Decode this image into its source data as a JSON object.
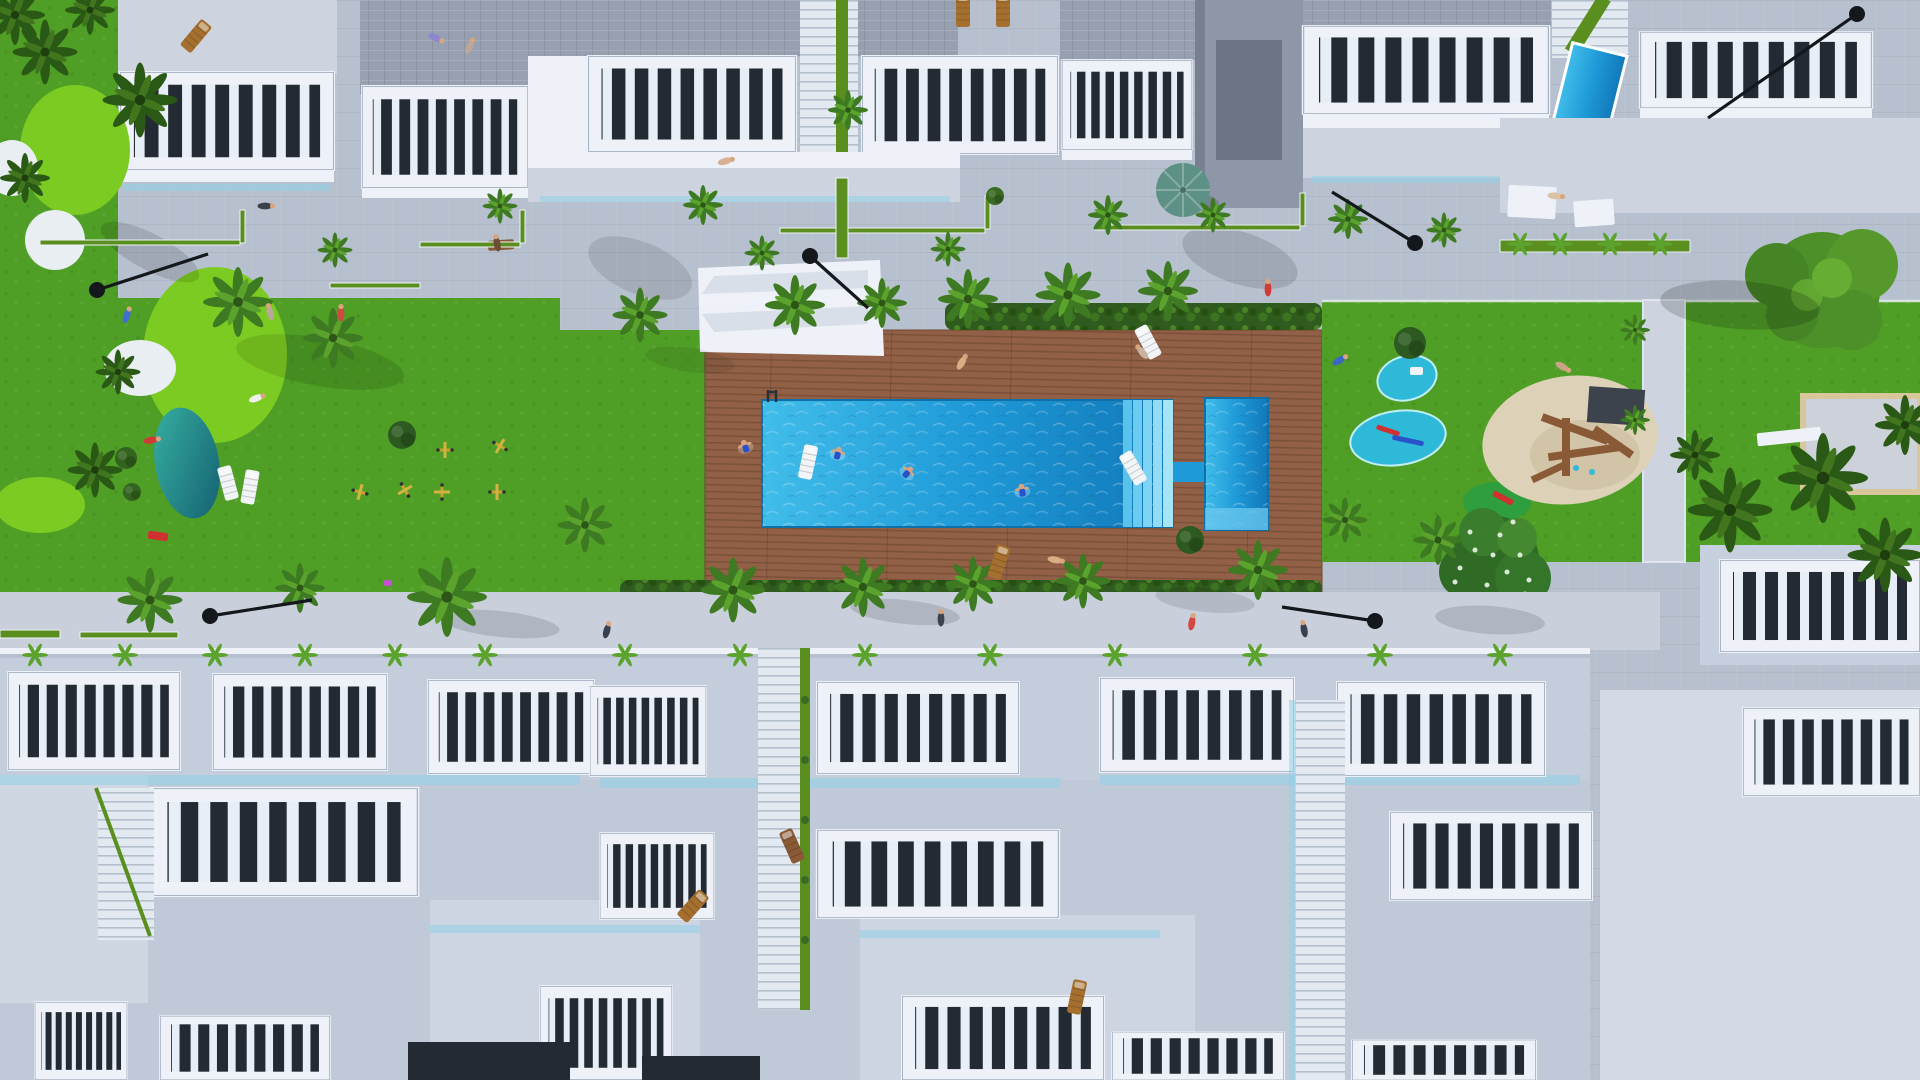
{
  "title": "aerial-render-residential-complex-with-pool",
  "colors": {
    "pavement": "#b7c0ce",
    "pavement_light": "#cdd4e0",
    "building_white": "#eef2f8",
    "building_shadow": "#c6d0de",
    "roof_gray": "#96a0b0",
    "facade_dark": "#8d97a8",
    "window_dark": "#232a33",
    "lawn": "#4f9e25",
    "lawn_light": "#63b52e",
    "golf_green": "#7ccb22",
    "bunker_white": "#e9eef2",
    "hedge": "#2f5c1e",
    "palm": "#3d7a22",
    "palm_light": "#5ca32e",
    "trunk": "#9b7d52",
    "deck": "#916046",
    "deck_stripe": "#7a5037",
    "pool_light": "#7fd4f2",
    "pool_mid": "#1f9ad8",
    "pool_deep": "#1480bf",
    "splash": "#2fb9d8",
    "sand": "#ddd2b8",
    "wood": "#8a5a36",
    "umbrella": "#5e9186",
    "mound_teal": "#1f8a8c",
    "lamp_black": "#14181d",
    "gym_yellow": "#c8a22c",
    "stair_green": "#5a8f1f",
    "court_gray": "#cdd2da",
    "court_border": "#d9c79c",
    "glass_blue": "#8fd2e8"
  },
  "scene": {
    "palms": [
      {
        "x": 45,
        "y": 52,
        "s": 1.3,
        "d": 1
      },
      {
        "x": 140,
        "y": 100,
        "s": 1.5,
        "d": 1
      },
      {
        "x": 25,
        "y": 178,
        "s": 1.0,
        "d": 1
      },
      {
        "x": 15,
        "y": 15,
        "s": 1.2,
        "d": 1
      },
      {
        "x": 90,
        "y": 10,
        "s": 1.0,
        "d": 1
      },
      {
        "x": 238,
        "y": 302,
        "s": 1.4
      },
      {
        "x": 333,
        "y": 338,
        "s": 1.2
      },
      {
        "x": 118,
        "y": 372,
        "s": 0.9,
        "d": 1
      },
      {
        "x": 95,
        "y": 470,
        "s": 1.1,
        "d": 1
      },
      {
        "x": 640,
        "y": 315,
        "s": 1.1
      },
      {
        "x": 795,
        "y": 305,
        "s": 1.2
      },
      {
        "x": 882,
        "y": 303,
        "s": 1.0
      },
      {
        "x": 968,
        "y": 299,
        "s": 1.2
      },
      {
        "x": 1068,
        "y": 295,
        "s": 1.3
      },
      {
        "x": 1168,
        "y": 291,
        "s": 1.2
      },
      {
        "x": 848,
        "y": 110,
        "s": 0.8
      },
      {
        "x": 335,
        "y": 250,
        "s": 0.7
      },
      {
        "x": 500,
        "y": 206,
        "s": 0.7
      },
      {
        "x": 703,
        "y": 205,
        "s": 0.8
      },
      {
        "x": 762,
        "y": 253,
        "s": 0.7
      },
      {
        "x": 948,
        "y": 249,
        "s": 0.7
      },
      {
        "x": 1108,
        "y": 215,
        "s": 0.8
      },
      {
        "x": 1213,
        "y": 215,
        "s": 0.7
      },
      {
        "x": 1348,
        "y": 219,
        "s": 0.8
      },
      {
        "x": 1444,
        "y": 230,
        "s": 0.7
      },
      {
        "x": 150,
        "y": 600,
        "s": 1.3
      },
      {
        "x": 300,
        "y": 588,
        "s": 1.0
      },
      {
        "x": 447,
        "y": 597,
        "s": 1.6
      },
      {
        "x": 585,
        "y": 525,
        "s": 1.1
      },
      {
        "x": 733,
        "y": 590,
        "s": 1.3
      },
      {
        "x": 863,
        "y": 587,
        "s": 1.2
      },
      {
        "x": 973,
        "y": 584,
        "s": 1.1
      },
      {
        "x": 1083,
        "y": 581,
        "s": 1.1
      },
      {
        "x": 1258,
        "y": 570,
        "s": 1.2
      },
      {
        "x": 1345,
        "y": 520,
        "s": 0.9
      },
      {
        "x": 1438,
        "y": 540,
        "s": 1.0
      },
      {
        "x": 1730,
        "y": 510,
        "s": 1.7,
        "d": 1
      },
      {
        "x": 1823,
        "y": 478,
        "s": 1.8,
        "d": 1
      },
      {
        "x": 1885,
        "y": 555,
        "s": 1.5,
        "d": 1
      },
      {
        "x": 1905,
        "y": 425,
        "s": 1.2,
        "d": 1
      },
      {
        "x": 1695,
        "y": 455,
        "s": 1.0,
        "d": 1
      },
      {
        "x": 1635,
        "y": 330,
        "s": 0.6
      },
      {
        "x": 1635,
        "y": 420,
        "s": 0.6
      }
    ],
    "agaves": [
      {
        "x": 35,
        "y": 655
      },
      {
        "x": 125,
        "y": 655
      },
      {
        "x": 215,
        "y": 655
      },
      {
        "x": 305,
        "y": 655
      },
      {
        "x": 395,
        "y": 655
      },
      {
        "x": 485,
        "y": 655
      },
      {
        "x": 625,
        "y": 655
      },
      {
        "x": 740,
        "y": 655
      },
      {
        "x": 865,
        "y": 655
      },
      {
        "x": 990,
        "y": 655
      },
      {
        "x": 1115,
        "y": 655
      },
      {
        "x": 1255,
        "y": 655
      },
      {
        "x": 1380,
        "y": 655
      },
      {
        "x": 1500,
        "y": 655
      },
      {
        "x": 1520,
        "y": 244
      },
      {
        "x": 1560,
        "y": 244
      },
      {
        "x": 1610,
        "y": 244
      },
      {
        "x": 1660,
        "y": 244
      }
    ],
    "lamps": [
      {
        "hx": 97,
        "hy": 290,
        "tx": 208,
        "ty": 254
      },
      {
        "hx": 810,
        "hy": 256,
        "tx": 868,
        "ty": 308
      },
      {
        "hx": 210,
        "hy": 616,
        "tx": 312,
        "ty": 600
      },
      {
        "hx": 1375,
        "hy": 621,
        "tx": 1282,
        "ty": 607
      },
      {
        "hx": 1415,
        "hy": 243,
        "tx": 1332,
        "ty": 192
      },
      {
        "hx": 1857,
        "hy": 14,
        "tx": 1708,
        "ty": 118
      }
    ],
    "people": [
      {
        "x": 127,
        "y": 315,
        "c": "#3f6fd0",
        "r": 20
      },
      {
        "x": 152,
        "y": 440,
        "c": "#d03b35",
        "r": 80
      },
      {
        "x": 270,
        "y": 312,
        "c": "#b9a79a",
        "r": -15
      },
      {
        "x": 341,
        "y": 313,
        "c": "#d24840",
        "r": 0
      },
      {
        "x": 266,
        "y": 206,
        "c": "#3a4048",
        "r": 90
      },
      {
        "x": 436,
        "y": 38,
        "c": "#8f86cf",
        "r": 115
      },
      {
        "x": 497,
        "y": 243,
        "c": "#6a4e35",
        "r": -10
      },
      {
        "x": 726,
        "y": 161,
        "c": "#d8b096",
        "r": 75
      },
      {
        "x": 962,
        "y": 362,
        "c": "#d9ad85",
        "r": 30
      },
      {
        "x": 1142,
        "y": 352,
        "c": "#c7b39f",
        "r": -40
      },
      {
        "x": 1056,
        "y": 560,
        "c": "#d9ad85",
        "r": 100
      },
      {
        "x": 941,
        "y": 618,
        "c": "#3c4452",
        "r": 0
      },
      {
        "x": 1192,
        "y": 622,
        "c": "#d24840",
        "r": 10
      },
      {
        "x": 1304,
        "y": 629,
        "c": "#39414e",
        "r": -10
      },
      {
        "x": 1268,
        "y": 288,
        "c": "#d03b35",
        "r": 0
      },
      {
        "x": 1556,
        "y": 196,
        "c": "#d9c3a4",
        "r": 95
      },
      {
        "x": 1340,
        "y": 360,
        "c": "#3e67c5",
        "r": 60
      },
      {
        "x": 1563,
        "y": 367,
        "c": "#caa285",
        "r": 120
      },
      {
        "x": 470,
        "y": 46,
        "c": "#b9a79a",
        "r": 25
      },
      {
        "x": 607,
        "y": 630,
        "c": "#39414e",
        "r": 15
      },
      {
        "x": 257,
        "y": 398,
        "c": "#eeeeee",
        "r": 70
      }
    ],
    "swimmers": [
      {
        "x": 745,
        "y": 446,
        "r": -20
      },
      {
        "x": 838,
        "y": 453,
        "r": 15
      },
      {
        "x": 908,
        "y": 472,
        "r": 40
      },
      {
        "x": 1022,
        "y": 490,
        "r": -10
      }
    ],
    "loungers": [
      {
        "x": 196,
        "y": 36,
        "r": 40,
        "c": "#a5702f"
      },
      {
        "x": 963,
        "y": 10,
        "r": 0,
        "c": "#a5702f"
      },
      {
        "x": 1003,
        "y": 10,
        "r": 0,
        "c": "#a5702f"
      },
      {
        "x": 1148,
        "y": 342,
        "r": -28,
        "c": "#f2f5f8"
      },
      {
        "x": 999,
        "y": 562,
        "r": 18,
        "c": "#a5702f"
      },
      {
        "x": 808,
        "y": 462,
        "r": 12,
        "c": "#f2f5f8"
      },
      {
        "x": 693,
        "y": 906,
        "r": 42,
        "c": "#a5702f"
      },
      {
        "x": 792,
        "y": 846,
        "r": -24,
        "c": "#8a5a36"
      },
      {
        "x": 1077,
        "y": 997,
        "r": 12,
        "c": "#a5702f"
      },
      {
        "x": 228,
        "y": 483,
        "r": -15,
        "c": "#f2f5f8"
      },
      {
        "x": 250,
        "y": 487,
        "r": 10,
        "c": "#f2f5f8"
      },
      {
        "x": 1133,
        "y": 468,
        "r": -30,
        "c": "#f2f5f8"
      }
    ],
    "gym": [
      {
        "x": 445,
        "y": 450
      },
      {
        "x": 500,
        "y": 446,
        "r": 30
      },
      {
        "x": 442,
        "y": 492,
        "r": 90
      },
      {
        "x": 497,
        "y": 492
      },
      {
        "x": 360,
        "y": 492,
        "r": 15
      },
      {
        "x": 405,
        "y": 490,
        "r": 60
      }
    ],
    "green_strips": [
      {
        "x": 40,
        "y": 240,
        "w": 200,
        "h": 5
      },
      {
        "x": 420,
        "y": 242,
        "w": 100,
        "h": 5
      },
      {
        "x": 780,
        "y": 228,
        "w": 205,
        "h": 5
      },
      {
        "x": 1095,
        "y": 225,
        "w": 205,
        "h": 5
      },
      {
        "x": 330,
        "y": 283,
        "w": 90,
        "h": 5
      },
      {
        "x": 240,
        "y": 210,
        "w": 5,
        "h": 33
      },
      {
        "x": 520,
        "y": 210,
        "w": 5,
        "h": 33
      },
      {
        "x": 985,
        "y": 196,
        "w": 5,
        "h": 33
      },
      {
        "x": 1300,
        "y": 193,
        "w": 5,
        "h": 33
      },
      {
        "x": 836,
        "y": 178,
        "w": 12,
        "h": 80
      },
      {
        "x": 0,
        "y": 630,
        "w": 60,
        "h": 8
      },
      {
        "x": 80,
        "y": 632,
        "w": 98,
        "h": 6
      },
      {
        "x": 1500,
        "y": 240,
        "w": 190,
        "h": 12
      }
    ],
    "bushes": [
      {
        "x": 1410,
        "y": 343,
        "r": 16,
        "c": "#2d5a20"
      },
      {
        "x": 402,
        "y": 435,
        "r": 14,
        "c": "#2d5a20"
      },
      {
        "x": 126,
        "y": 458,
        "r": 11,
        "c": "#33641f"
      },
      {
        "x": 132,
        "y": 492,
        "r": 9,
        "c": "#33641f"
      },
      {
        "x": 995,
        "y": 196,
        "r": 9,
        "c": "#3a6b24"
      },
      {
        "x": 1190,
        "y": 540,
        "r": 14,
        "c": "#2d5a20"
      }
    ],
    "toys": [
      {
        "x": 1376,
        "y": 428,
        "w": 24,
        "h": 5,
        "r": 18,
        "c": "#d03030"
      },
      {
        "x": 1392,
        "y": 438,
        "w": 32,
        "h": 5,
        "r": 12,
        "c": "#2a52c8"
      },
      {
        "x": 1410,
        "y": 367,
        "w": 13,
        "h": 8,
        "r": 0,
        "c": "#f0f4f8"
      },
      {
        "x": 1492,
        "y": 495,
        "w": 22,
        "h": 6,
        "r": 28,
        "c": "#d03030"
      },
      {
        "x": 148,
        "y": 532,
        "w": 20,
        "h": 8,
        "r": 8,
        "c": "#d03030"
      },
      {
        "x": 384,
        "y": 580,
        "w": 8,
        "h": 6,
        "r": 0,
        "c": "#c44fd0"
      }
    ],
    "shadows": [
      {
        "x": 640,
        "y": 268,
        "rx": 55,
        "ry": 26,
        "r": 22,
        "o": 0.1
      },
      {
        "x": 1240,
        "y": 258,
        "rx": 60,
        "ry": 26,
        "r": 18,
        "o": 0.12
      },
      {
        "x": 500,
        "y": 624,
        "rx": 60,
        "ry": 13,
        "r": 6,
        "o": 0.12
      },
      {
        "x": 905,
        "y": 612,
        "rx": 55,
        "ry": 12,
        "r": 6,
        "o": 0.12
      },
      {
        "x": 1205,
        "y": 600,
        "rx": 50,
        "ry": 12,
        "r": 6,
        "o": 0.1
      },
      {
        "x": 1740,
        "y": 305,
        "rx": 80,
        "ry": 24,
        "r": 4,
        "o": 0.16
      },
      {
        "x": 320,
        "y": 362,
        "rx": 85,
        "ry": 24,
        "r": 10,
        "o": 0.1
      },
      {
        "x": 150,
        "y": 252,
        "rx": 55,
        "ry": 18,
        "r": 28,
        "o": 0.12
      },
      {
        "x": 690,
        "y": 360,
        "rx": 45,
        "ry": 12,
        "r": 8,
        "o": 0.08
      },
      {
        "x": 1490,
        "y": 620,
        "rx": 55,
        "ry": 14,
        "r": 4,
        "o": 0.12
      }
    ]
  }
}
